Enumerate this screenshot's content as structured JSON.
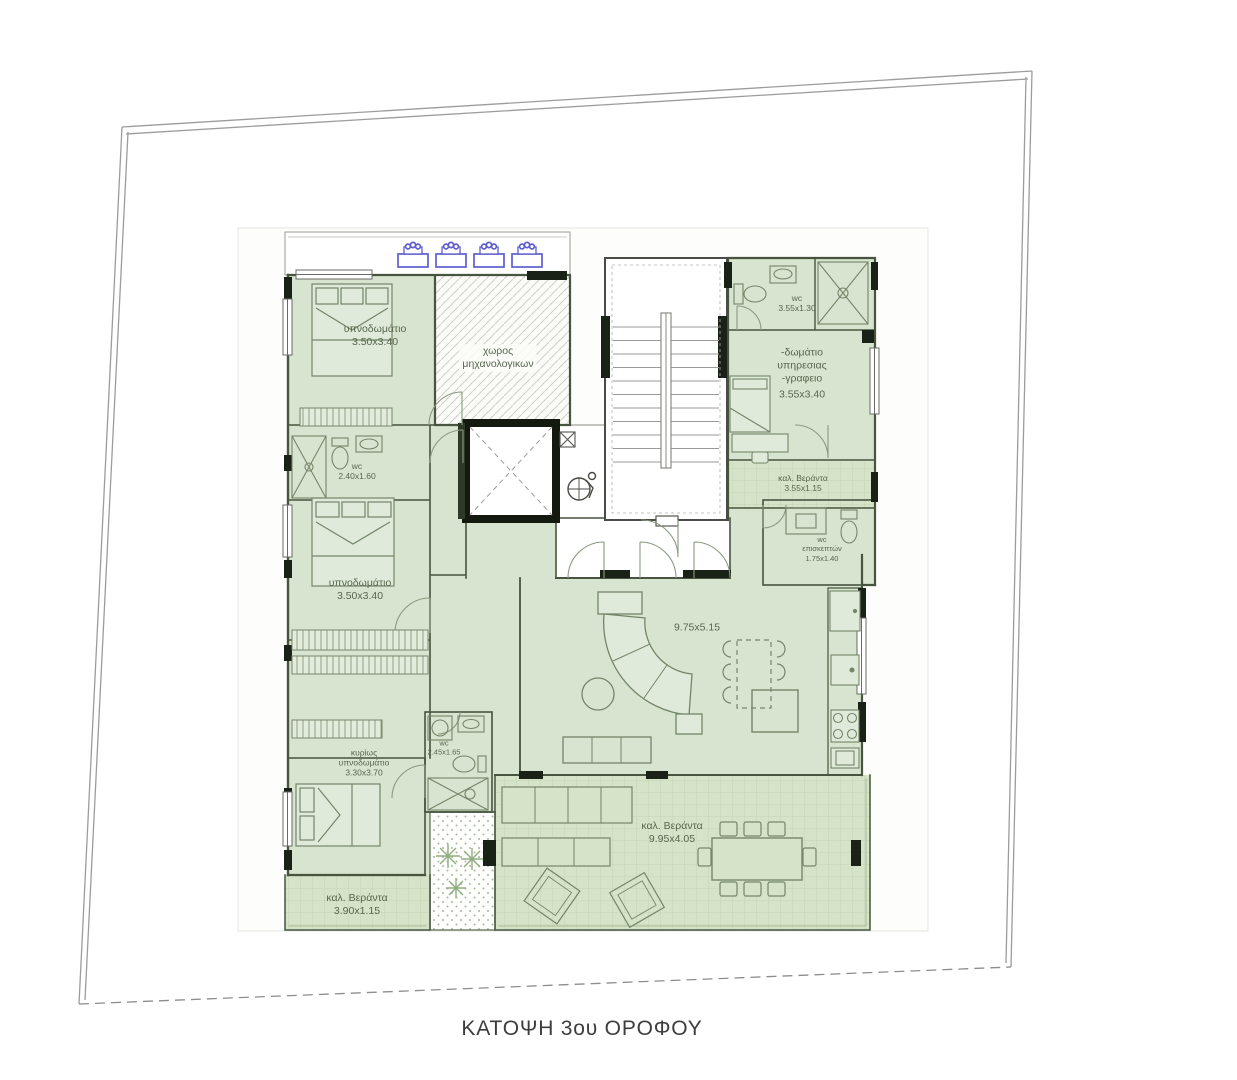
{
  "title": "ΚΑΤΟΨΗ 3ου ΟΡΟΦΟΥ",
  "rooms": {
    "bedroom_top_left": {
      "name": "υπνοδωμάτιο",
      "dims": "3.50x3.40"
    },
    "mechanical_space": {
      "line1": "χωρος",
      "line2": "μηχανολογικων"
    },
    "wc_top_right": {
      "name": "wc",
      "dims": "3.55x1.30"
    },
    "service_room_office": {
      "line1": "-δωμάτιο",
      "line2": "υπηρεσιας",
      "line3": "-γραφειο",
      "dims": "3.55x3.40"
    },
    "veranda_right": {
      "name": "καλ. Βεράντα",
      "dims": "3.55x1.15"
    },
    "wc_left": {
      "name": "wc",
      "dims": "2.40x1.60"
    },
    "bedroom_mid_left": {
      "name": "υπνοδωμάτιο",
      "dims": "3.50x3.40"
    },
    "wc_guests": {
      "line1": "wc",
      "line2": "επισκεπτών",
      "dims": "1.75x1.40"
    },
    "living_dining": {
      "dims": "9.75x5.15"
    },
    "master_bedroom": {
      "line1": "κυρίως",
      "line2": "υπνοδωμάτιο",
      "dims": "3.30x3.70"
    },
    "wc_middle": {
      "name": "wc",
      "dims": "2.45x1.65"
    },
    "veranda_bottom": {
      "name": "καλ. Βεράντα",
      "dims": "9.95x4.05"
    },
    "veranda_bottom_left": {
      "name": "καλ. Βεράντα",
      "dims": "3.90x1.15"
    }
  },
  "icons": {
    "solar_heaters": {
      "name": "solar-water-heater-icon",
      "count": 4
    }
  },
  "colors": {
    "room_fill": "#d7e4cf",
    "veranda_fill": "#d5e3c8",
    "wall_dark": "#1a2116",
    "wall_line": "#47543f",
    "label_text": "#57684f",
    "solar_icon_blue": "#5e5ed0",
    "title_text": "#3d3d3d"
  }
}
